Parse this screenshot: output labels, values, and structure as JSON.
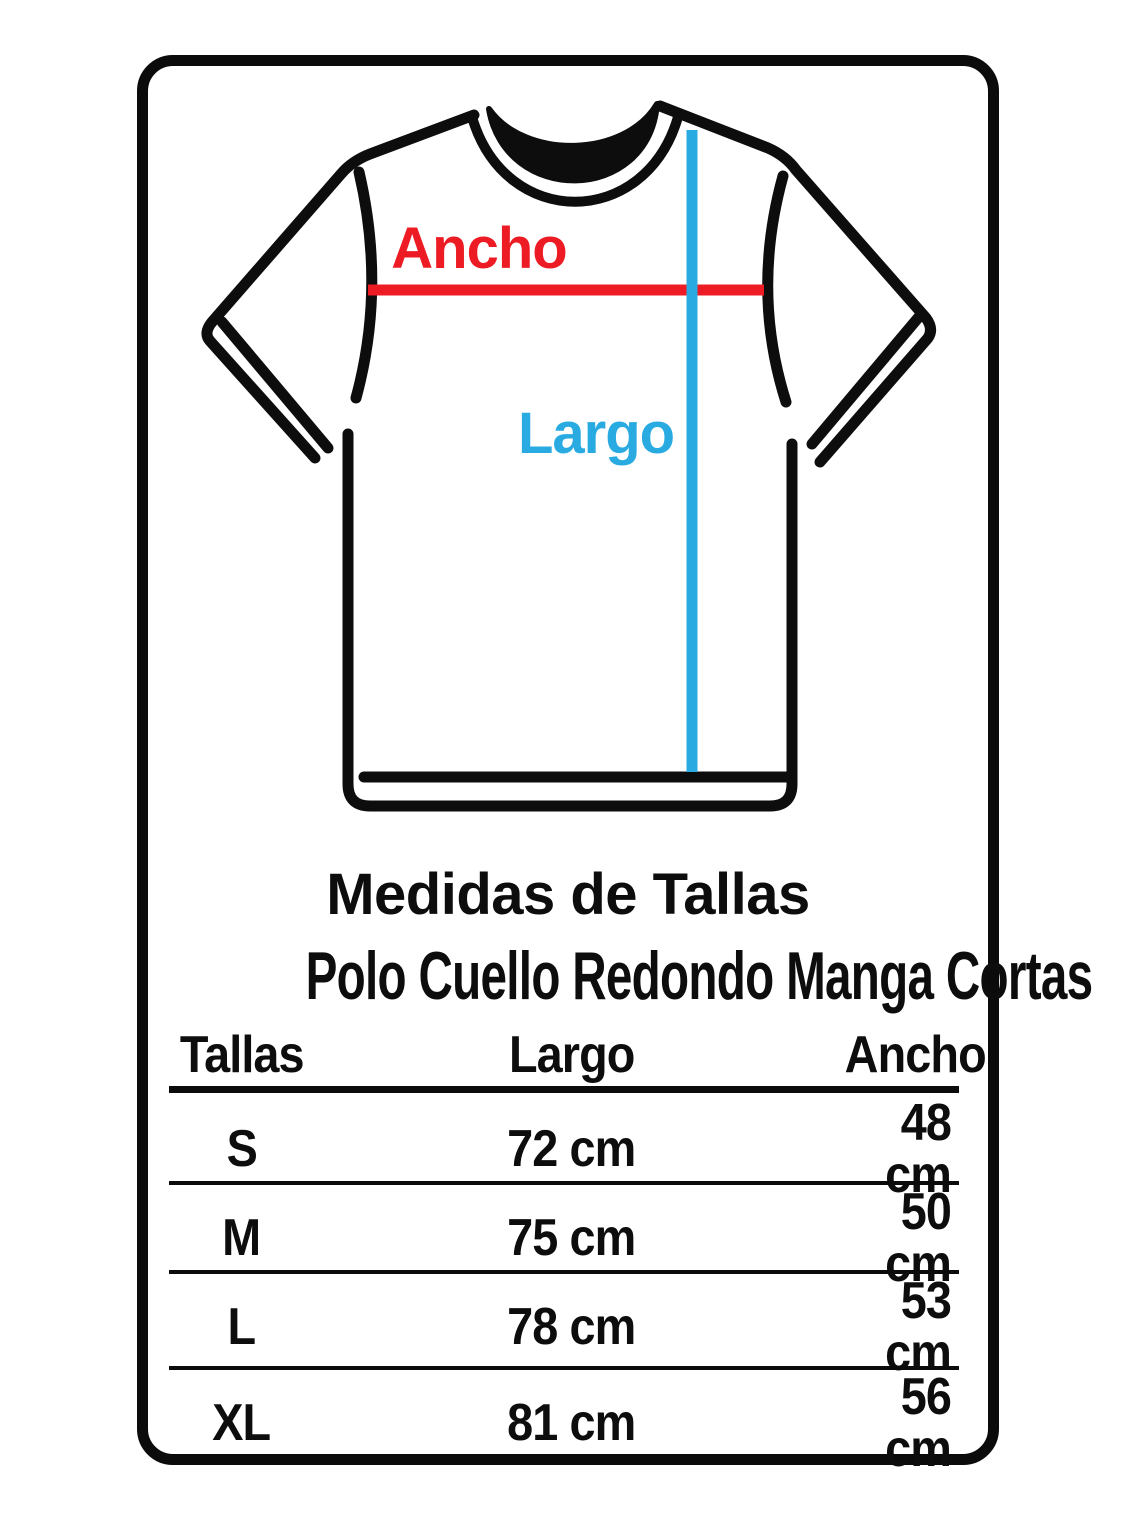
{
  "title": "Medidas de Tallas",
  "subtitle": "Polo Cuello Redondo Manga Cortas",
  "shirt_diagram": {
    "width_label": "Ancho",
    "length_label": "Largo",
    "width_color": "#ed1c24",
    "length_color": "#29abe2",
    "outline_color": "#0d0d0d"
  },
  "table": {
    "headers": {
      "size": "Tallas",
      "length": "Largo",
      "width": "Ancho"
    },
    "rows": [
      {
        "size": "S",
        "largo": "72 cm",
        "ancho": "48 cm"
      },
      {
        "size": "M",
        "largo": "75 cm",
        "ancho": "50 cm"
      },
      {
        "size": "L",
        "largo": "78 cm",
        "ancho": "53 cm"
      },
      {
        "size": "XL",
        "largo": "81 cm",
        "ancho": "56 cm"
      }
    ]
  }
}
